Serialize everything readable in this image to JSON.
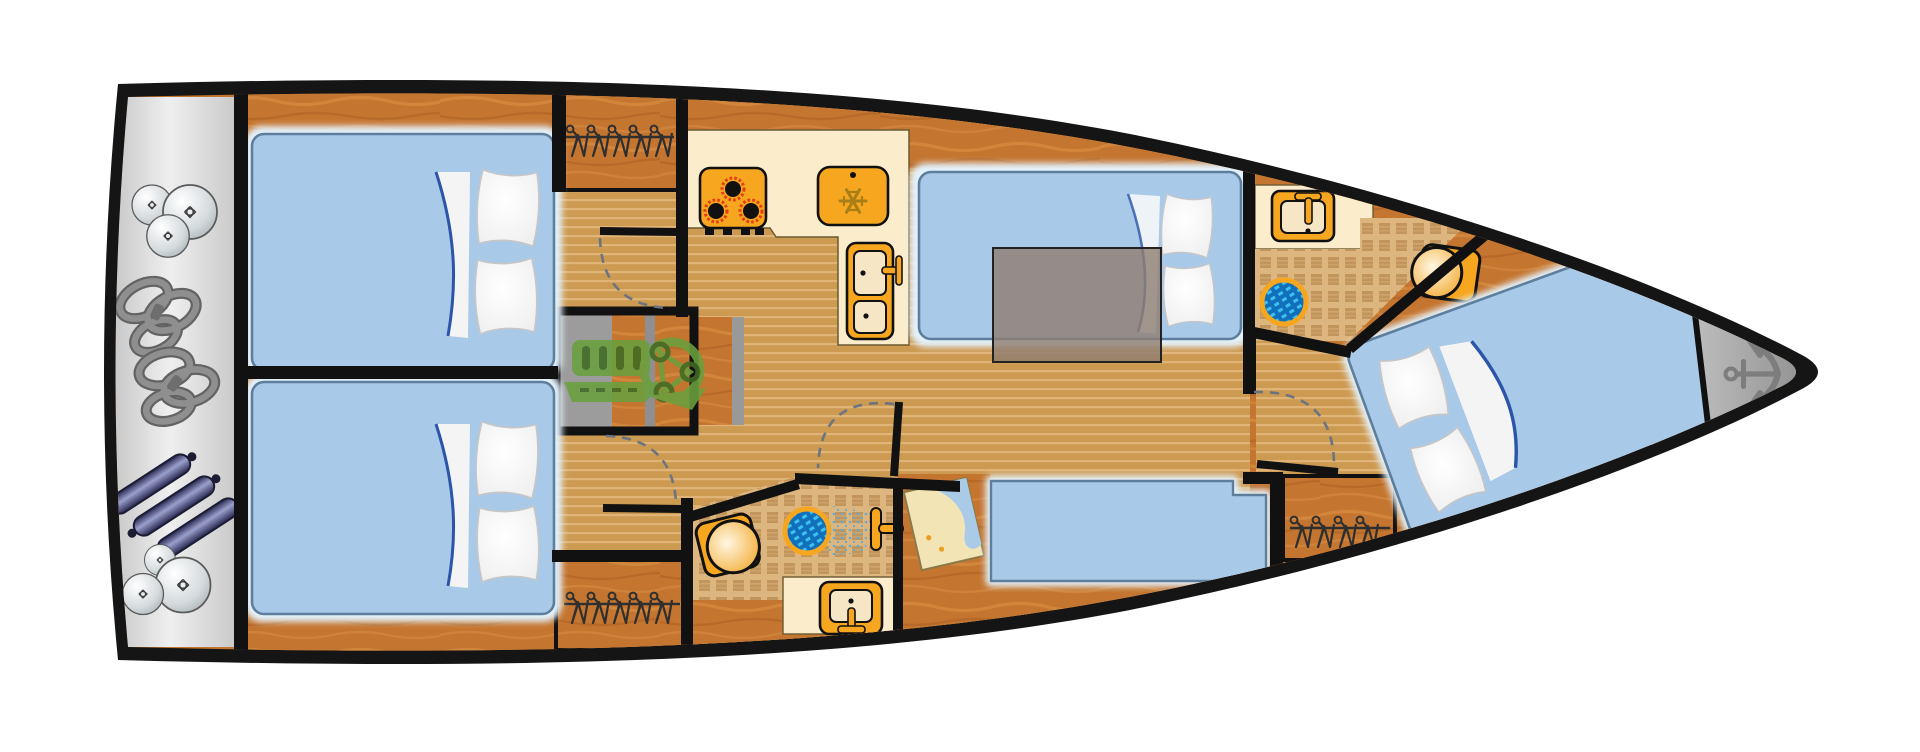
{
  "meta": {
    "label": "Sailing yacht interior floor plan, top-down view, bow pointing right"
  },
  "palette": {
    "hull": "#151515",
    "wall": "#111111",
    "sternA": "#c9c9c9",
    "sternB": "#efefef",
    "wood": "#c4752f",
    "woodGrain": "#da8f44",
    "woodDark": "#a55c20",
    "sole": "#cd9a52",
    "soleLine": "#e0b477",
    "tileBg": "#ddb67f",
    "tileSq": "#c1955b",
    "bedFill": "#a9c9e9",
    "bedGlow": "#e3f2fc",
    "bedEdge": "#5d7f9d",
    "sheetBlue": "#2b55a8",
    "orange": "#f6a61f",
    "cream": "#fbeccb",
    "basin": "#f7e6c6",
    "table": "#8e7d70",
    "drainBlue": "#1070bb",
    "drainLite": "#3ec1ef",
    "engine": "#69a03e",
    "engineDark": "#3f6b24",
    "anchor": "#7d7d7d",
    "navy": "#26264e",
    "navyLite": "#9aa0cc",
    "rope": "#8f8f8f",
    "ropeDark": "#636363",
    "hanger": "#2f2f2f",
    "mapPaper": "#f2e4b4",
    "mapWater": "#a9cbe8",
    "mapDot": "#e8a020",
    "spray": "#58aede",
    "arc": "#6b7480"
  },
  "rooms": [
    {
      "name": "stern-platform",
      "items": [
        "fender-ball-icon",
        "mooring-rope-icon",
        "cylinder-fender-icon"
      ]
    },
    {
      "name": "aft-cabin-port",
      "items": [
        "double-berth",
        "pillow-icon",
        "hanging-locker",
        "door-swing"
      ]
    },
    {
      "name": "aft-cabin-starboard",
      "items": [
        "double-berth",
        "pillow-icon",
        "hanging-locker",
        "door-swing"
      ]
    },
    {
      "name": "companionway",
      "items": [
        "steps",
        "engine-icon"
      ]
    },
    {
      "name": "galley",
      "items": [
        "stove-icon",
        "fridge-icon",
        "double-sink-icon"
      ]
    },
    {
      "name": "saloon",
      "items": [
        "convertible-settee",
        "saloon-table",
        "bench-settee"
      ]
    },
    {
      "name": "aft-head",
      "items": [
        "toilet-icon",
        "shower-drain-icon",
        "hand-shower-icon",
        "sink-icon"
      ]
    },
    {
      "name": "nav-station",
      "items": [
        "chart-table",
        "sea-chart-icon"
      ]
    },
    {
      "name": "forward-head",
      "items": [
        "sink-icon",
        "shower-drain-icon",
        "toilet-icon",
        "door-swing"
      ]
    },
    {
      "name": "forward-cabin",
      "items": [
        "v-berth",
        "pillow-icon",
        "hanging-locker",
        "door-swing"
      ]
    },
    {
      "name": "bow-locker",
      "items": [
        "anchor-icon"
      ]
    }
  ]
}
